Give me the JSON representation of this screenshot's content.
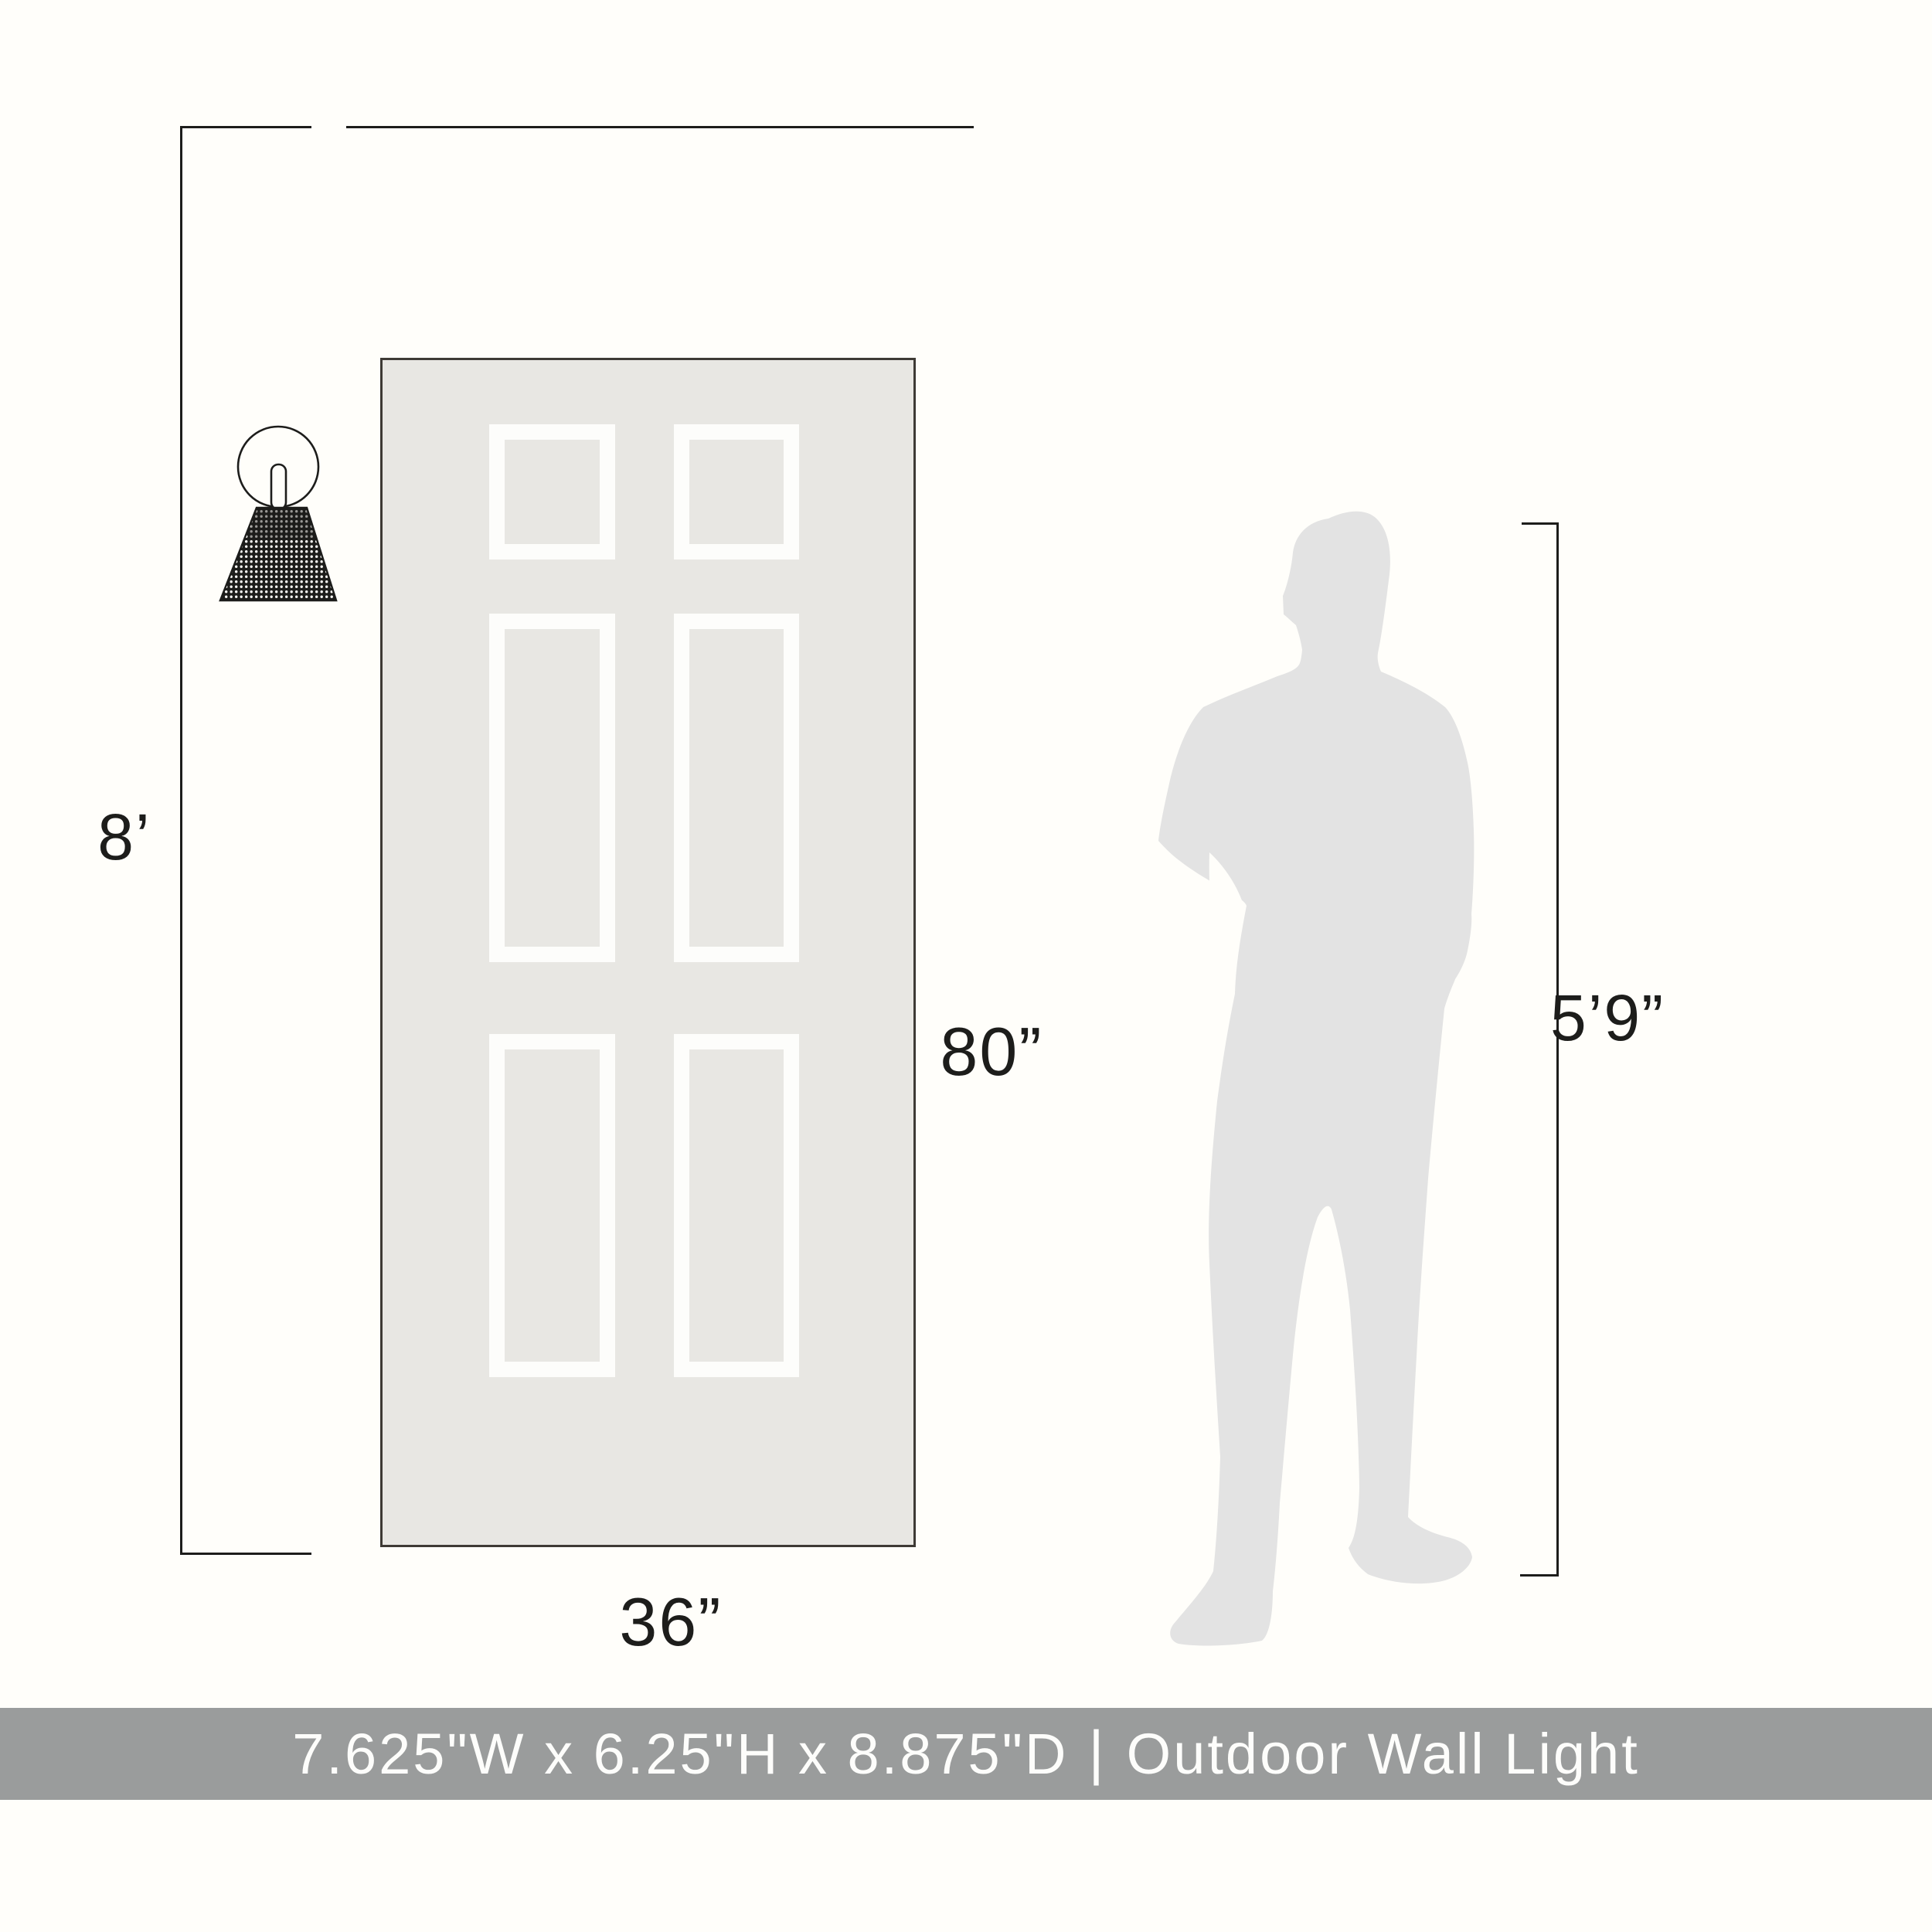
{
  "colors": {
    "background": "#fffefa",
    "line": "#1d1d1b",
    "door_fill": "#e8e7e3",
    "door_border": "#3e3a35",
    "panel_frame": "#fdfdfb",
    "person_fill": "#e3e3e3",
    "banner_bg": "#9a9c9c",
    "banner_text_color": "#fdfdfb"
  },
  "labels": {
    "ceiling_height": "8’",
    "door_height": "80”",
    "door_width": "36”",
    "person_height": "5’9”"
  },
  "banner": {
    "size_text": "7.625\"W x 6.25\"H x 8.875\"D",
    "divider": "|",
    "product_text": "Outdoor Wall Light"
  },
  "scene": {
    "icons": [
      "wall-sconce",
      "six-panel-door",
      "person-silhouette"
    ],
    "door_panel_count": 6
  }
}
